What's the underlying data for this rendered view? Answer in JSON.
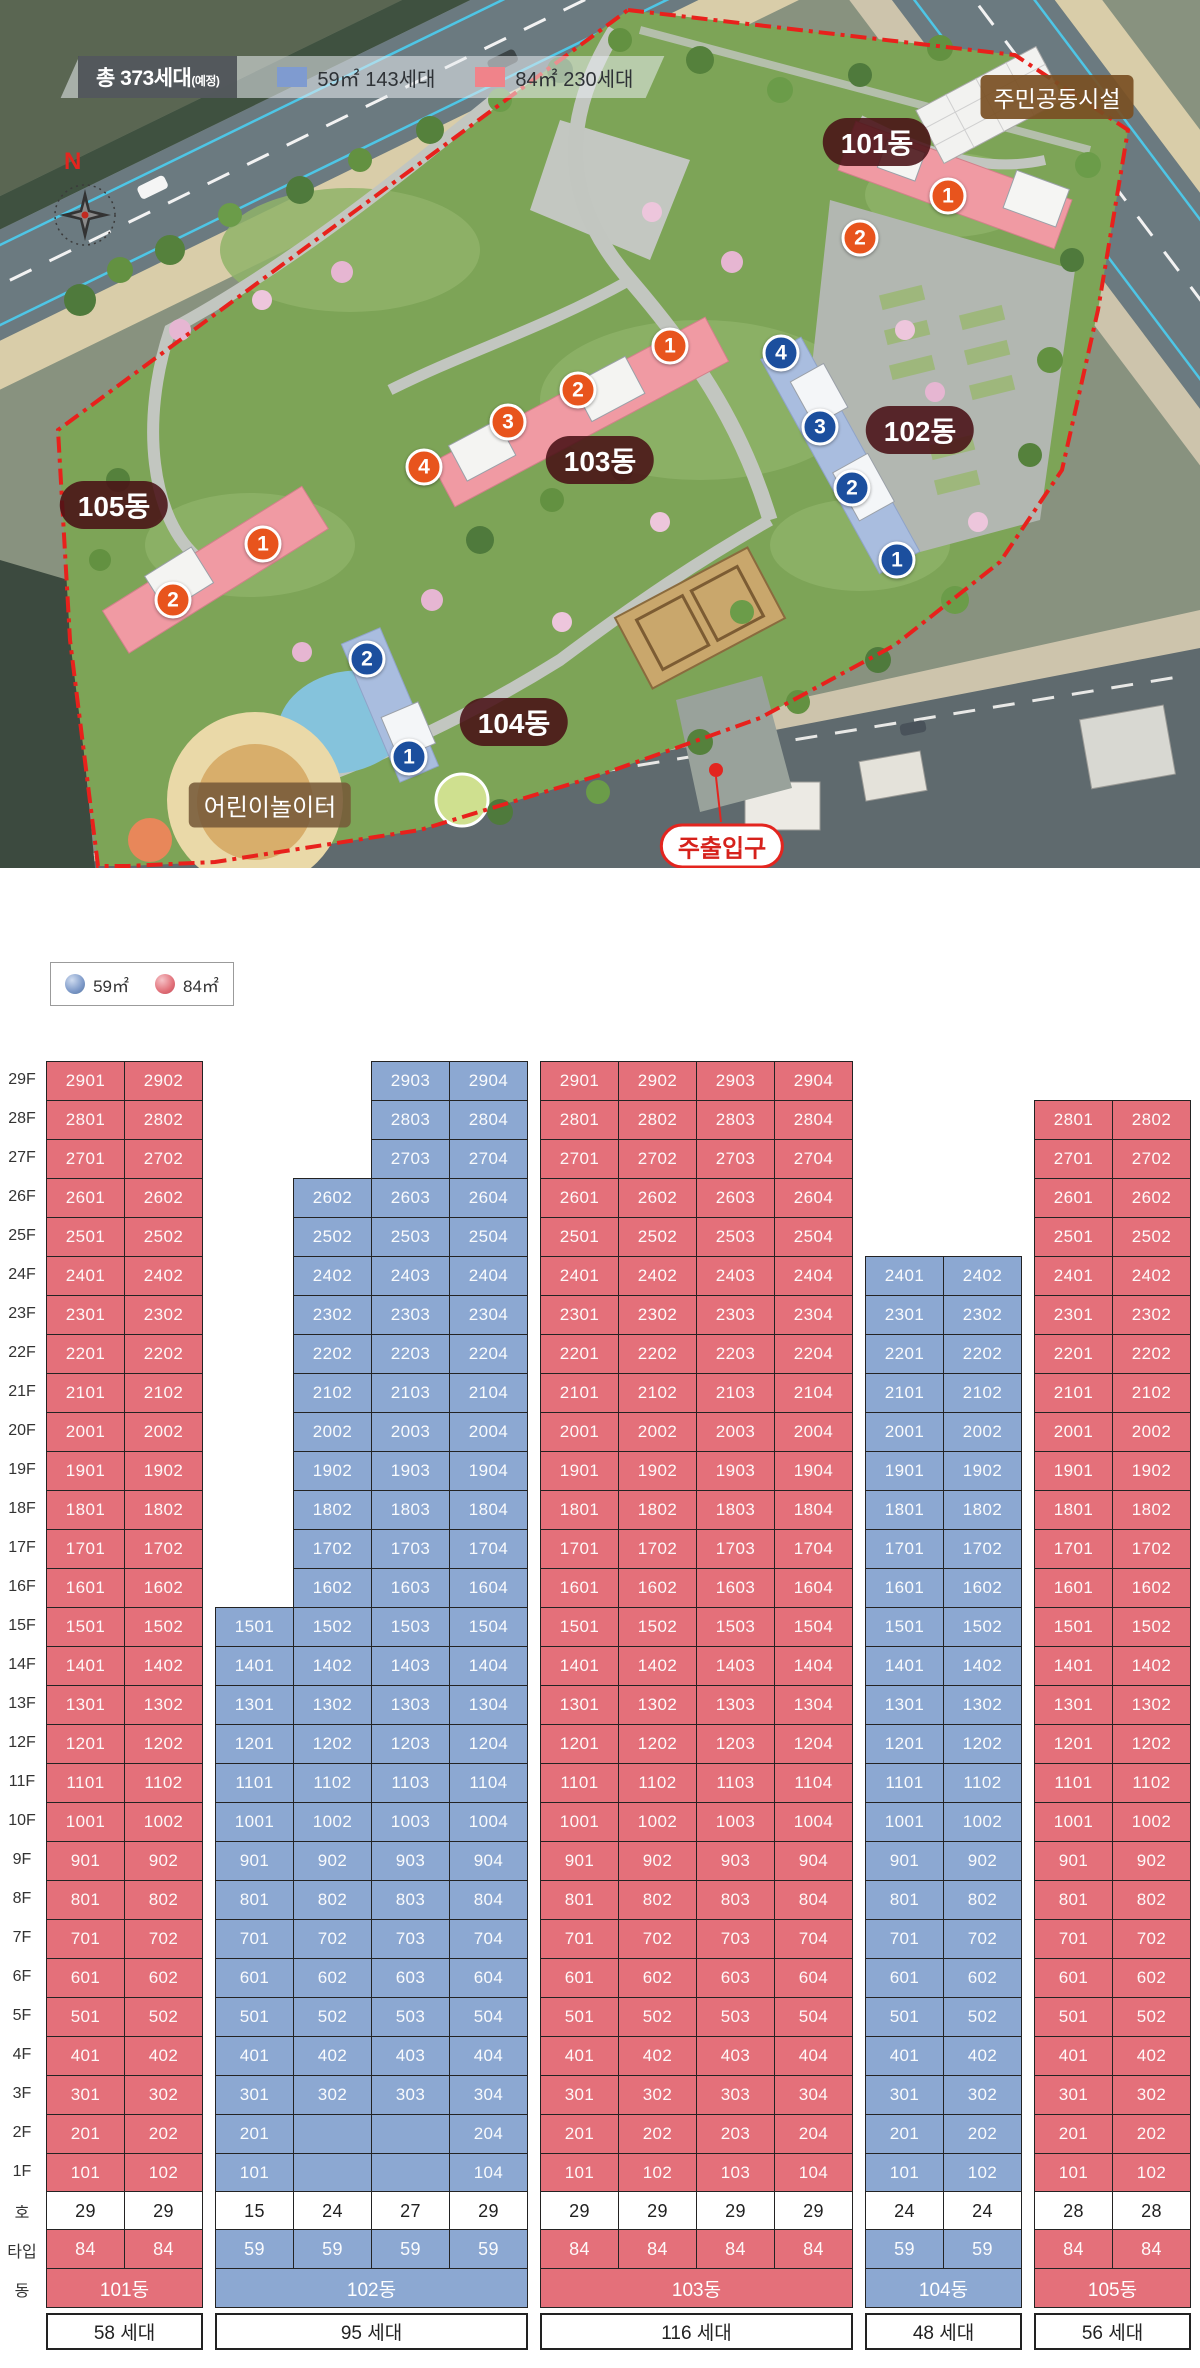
{
  "site_plan": {
    "legend": {
      "total_label": "총 373세대",
      "total_suffix": "(예정)",
      "items": [
        {
          "swatch": "#7f9bd0",
          "label": "59㎡ 143세대"
        },
        {
          "swatch": "#f0838a",
          "label": "84㎡ 230세대"
        }
      ]
    },
    "compass": "N",
    "facility_labels": {
      "community": "주민공동시설",
      "playground": "어린이놀이터",
      "entrance": "주출입구"
    },
    "building_labels": [
      "101동",
      "102동",
      "103동",
      "104동",
      "105동"
    ],
    "markers": [
      {
        "building": "101동",
        "no": "1"
      },
      {
        "building": "101동",
        "no": "2"
      },
      {
        "building": "102동",
        "no": "4"
      },
      {
        "building": "102동",
        "no": "3"
      },
      {
        "building": "102동",
        "no": "2"
      },
      {
        "building": "102동",
        "no": "1"
      },
      {
        "building": "103동",
        "no": "1"
      },
      {
        "building": "103동",
        "no": "2"
      },
      {
        "building": "103동",
        "no": "3"
      },
      {
        "building": "103동",
        "no": "4"
      },
      {
        "building": "104동",
        "no": "2"
      },
      {
        "building": "104동",
        "no": "1"
      },
      {
        "building": "105동",
        "no": "1"
      },
      {
        "building": "105동",
        "no": "2"
      }
    ]
  },
  "chart_legend": {
    "items": [
      {
        "label": "59㎡",
        "color": "#8ca8d2"
      },
      {
        "label": "84㎡",
        "color": "#e4707a"
      }
    ]
  },
  "chart_data": {
    "type": "stacking-table",
    "title": "동·호수 배치도",
    "floor_labels": [
      "29F",
      "28F",
      "27F",
      "26F",
      "25F",
      "24F",
      "23F",
      "22F",
      "21F",
      "20F",
      "19F",
      "18F",
      "17F",
      "16F",
      "15F",
      "14F",
      "13F",
      "12F",
      "11F",
      "10F",
      "9F",
      "8F",
      "7F",
      "6F",
      "5F",
      "4F",
      "3F",
      "2F",
      "1F"
    ],
    "row_headers": {
      "ho": "호",
      "type": "타입",
      "dong": "동"
    },
    "colors": {
      "59": "#8ca8d2",
      "84": "#e4707a"
    },
    "unit_rule": "unit label = floor*100 + stack index (e.g. 2901)",
    "buildings": [
      {
        "name": "101동",
        "type": "84",
        "total": "58 세대",
        "columns": [
          {
            "from": 1,
            "to": 29,
            "ho": "29"
          },
          {
            "from": 1,
            "to": 29,
            "ho": "29"
          }
        ]
      },
      {
        "name": "102동",
        "type": "59",
        "total": "95 세대",
        "columns": [
          {
            "from": 1,
            "to": 15,
            "ho": "15"
          },
          {
            "from": 3,
            "to": 26,
            "ho": "24",
            "x_floors": [
              2,
              1
            ]
          },
          {
            "from": 3,
            "to": 29,
            "ho": "27",
            "x_floors": [
              2,
              1
            ]
          },
          {
            "from": 1,
            "to": 29,
            "ho": "29"
          }
        ]
      },
      {
        "name": "103동",
        "type": "84",
        "total": "116 세대",
        "columns": [
          {
            "from": 1,
            "to": 29,
            "ho": "29"
          },
          {
            "from": 1,
            "to": 29,
            "ho": "29"
          },
          {
            "from": 1,
            "to": 29,
            "ho": "29"
          },
          {
            "from": 1,
            "to": 29,
            "ho": "29"
          }
        ]
      },
      {
        "name": "104동",
        "type": "59",
        "total": "48 세대",
        "columns": [
          {
            "from": 1,
            "to": 24,
            "ho": "24"
          },
          {
            "from": 1,
            "to": 24,
            "ho": "24"
          }
        ]
      },
      {
        "name": "105동",
        "type": "84",
        "total": "56 세대",
        "columns": [
          {
            "from": 1,
            "to": 28,
            "ho": "28"
          },
          {
            "from": 1,
            "to": 28,
            "ho": "28"
          }
        ]
      }
    ]
  }
}
